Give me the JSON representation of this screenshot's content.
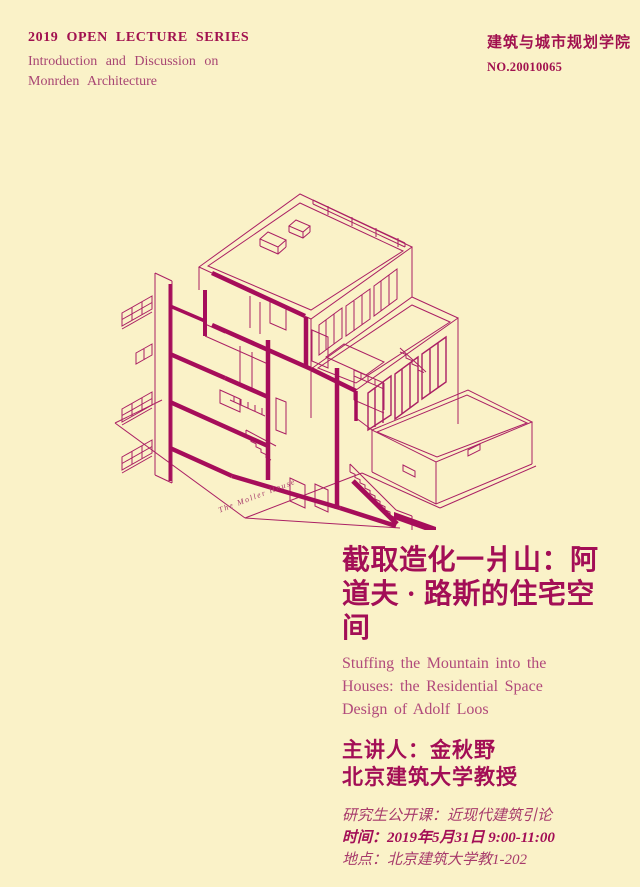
{
  "colors": {
    "background": "#faf2c8",
    "ink": "#a30e56",
    "ink_light": "#b14a7b",
    "line": "#ab2064",
    "line_thick": "#a60d5a"
  },
  "header": {
    "series_title": "2019 OPEN LECTURE SERIES",
    "series_subtitle_line1": "Introduction and Discussion on",
    "series_subtitle_line2": "Monrden Architecture",
    "school": "建筑与城市规划学院",
    "lecture_no": "NO.20010065"
  },
  "drawing": {
    "caption": "The Moller House"
  },
  "body": {
    "title_zh": [
      "截取造化一爿山：阿",
      "道夫 · 路斯的住宅空",
      "间"
    ],
    "title_en": [
      "Stuffing the Mountain into the",
      "Houses: the Residential Space",
      "Design of Adolf Loos"
    ],
    "speaker_line1": "主讲人：金秋野",
    "speaker_line2": "北京建筑大学教授",
    "course": "研究生公开课：近现代建筑引论",
    "time": "时间：2019年5月31日 9:00-11:00",
    "location": "地点：北京建筑大学教1-202"
  }
}
